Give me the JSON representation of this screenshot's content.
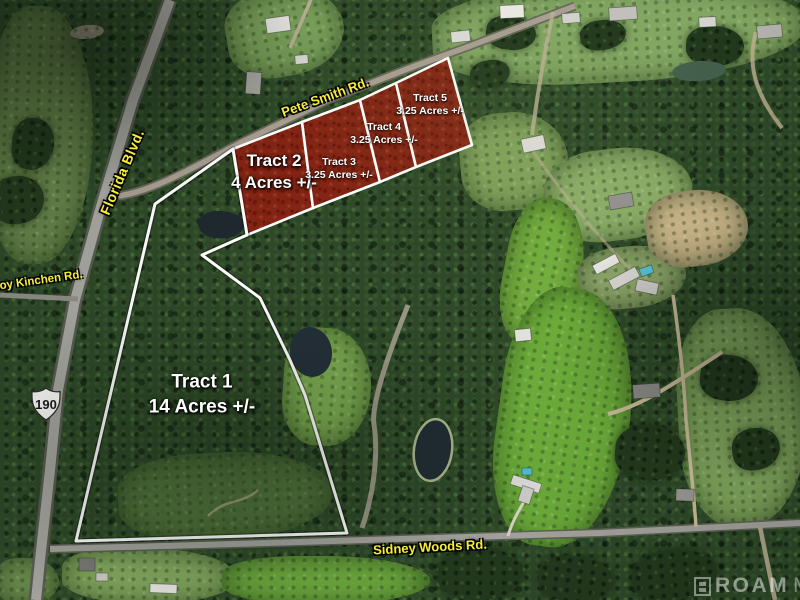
{
  "map": {
    "tracts": [
      {
        "name": "Tract 1",
        "acreage": "14 Acres +/-"
      },
      {
        "name": "Tract 2",
        "acreage": "4 Acres +/-"
      },
      {
        "name": "Tract 3",
        "acreage": "3.25 Acres +/-"
      },
      {
        "name": "Tract 4",
        "acreage": "3.25 Acres +/-"
      },
      {
        "name": "Tract 5",
        "acreage": "3.25 Acres +/-"
      }
    ],
    "roads": {
      "pete_smith": "Pete Smith Rd.",
      "florida_blvd": "Florida Blvd.",
      "coy_kinchen": "Coy Kinchen Rd.",
      "sidney_woods": "Sidney Woods Rd."
    },
    "highway_shield": {
      "route": "190"
    },
    "watermark": {
      "brand": "ROAM",
      "suffix": "MLS"
    },
    "colors": {
      "tract_overlay": "#8a1e10",
      "boundary_line": "#ffffff",
      "road_label_yellow": "#f7ee3c",
      "tract_label_white": "#ffffff"
    }
  }
}
